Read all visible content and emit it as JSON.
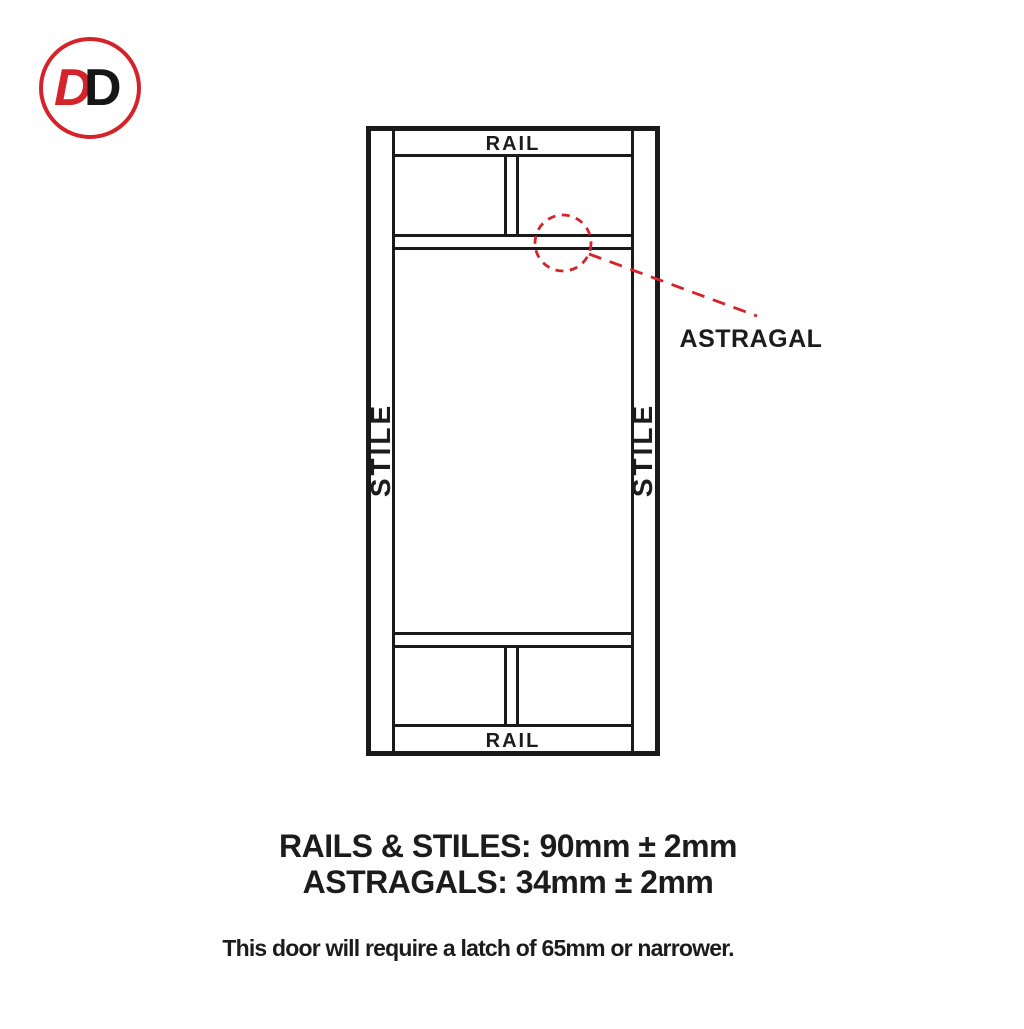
{
  "logo": {
    "letter_red": "D",
    "letter_black": "D",
    "ring_color": "#d4232a",
    "letter_black_color": "#161616"
  },
  "diagram": {
    "rail_top_label": "RAIL",
    "rail_bottom_label": "RAIL",
    "stile_left_label": "STILE",
    "stile_right_label": "STILE",
    "callout_label": "ASTRAGAL",
    "line_color": "#1a1a1a",
    "accent_color": "#d4232a"
  },
  "specs": {
    "rails_stiles": "RAILS & STILES: 90mm ± 2mm",
    "astragals": "ASTRAGALS: 34mm ± 2mm",
    "latch_note": "This door will require a latch of 65mm or narrower."
  }
}
